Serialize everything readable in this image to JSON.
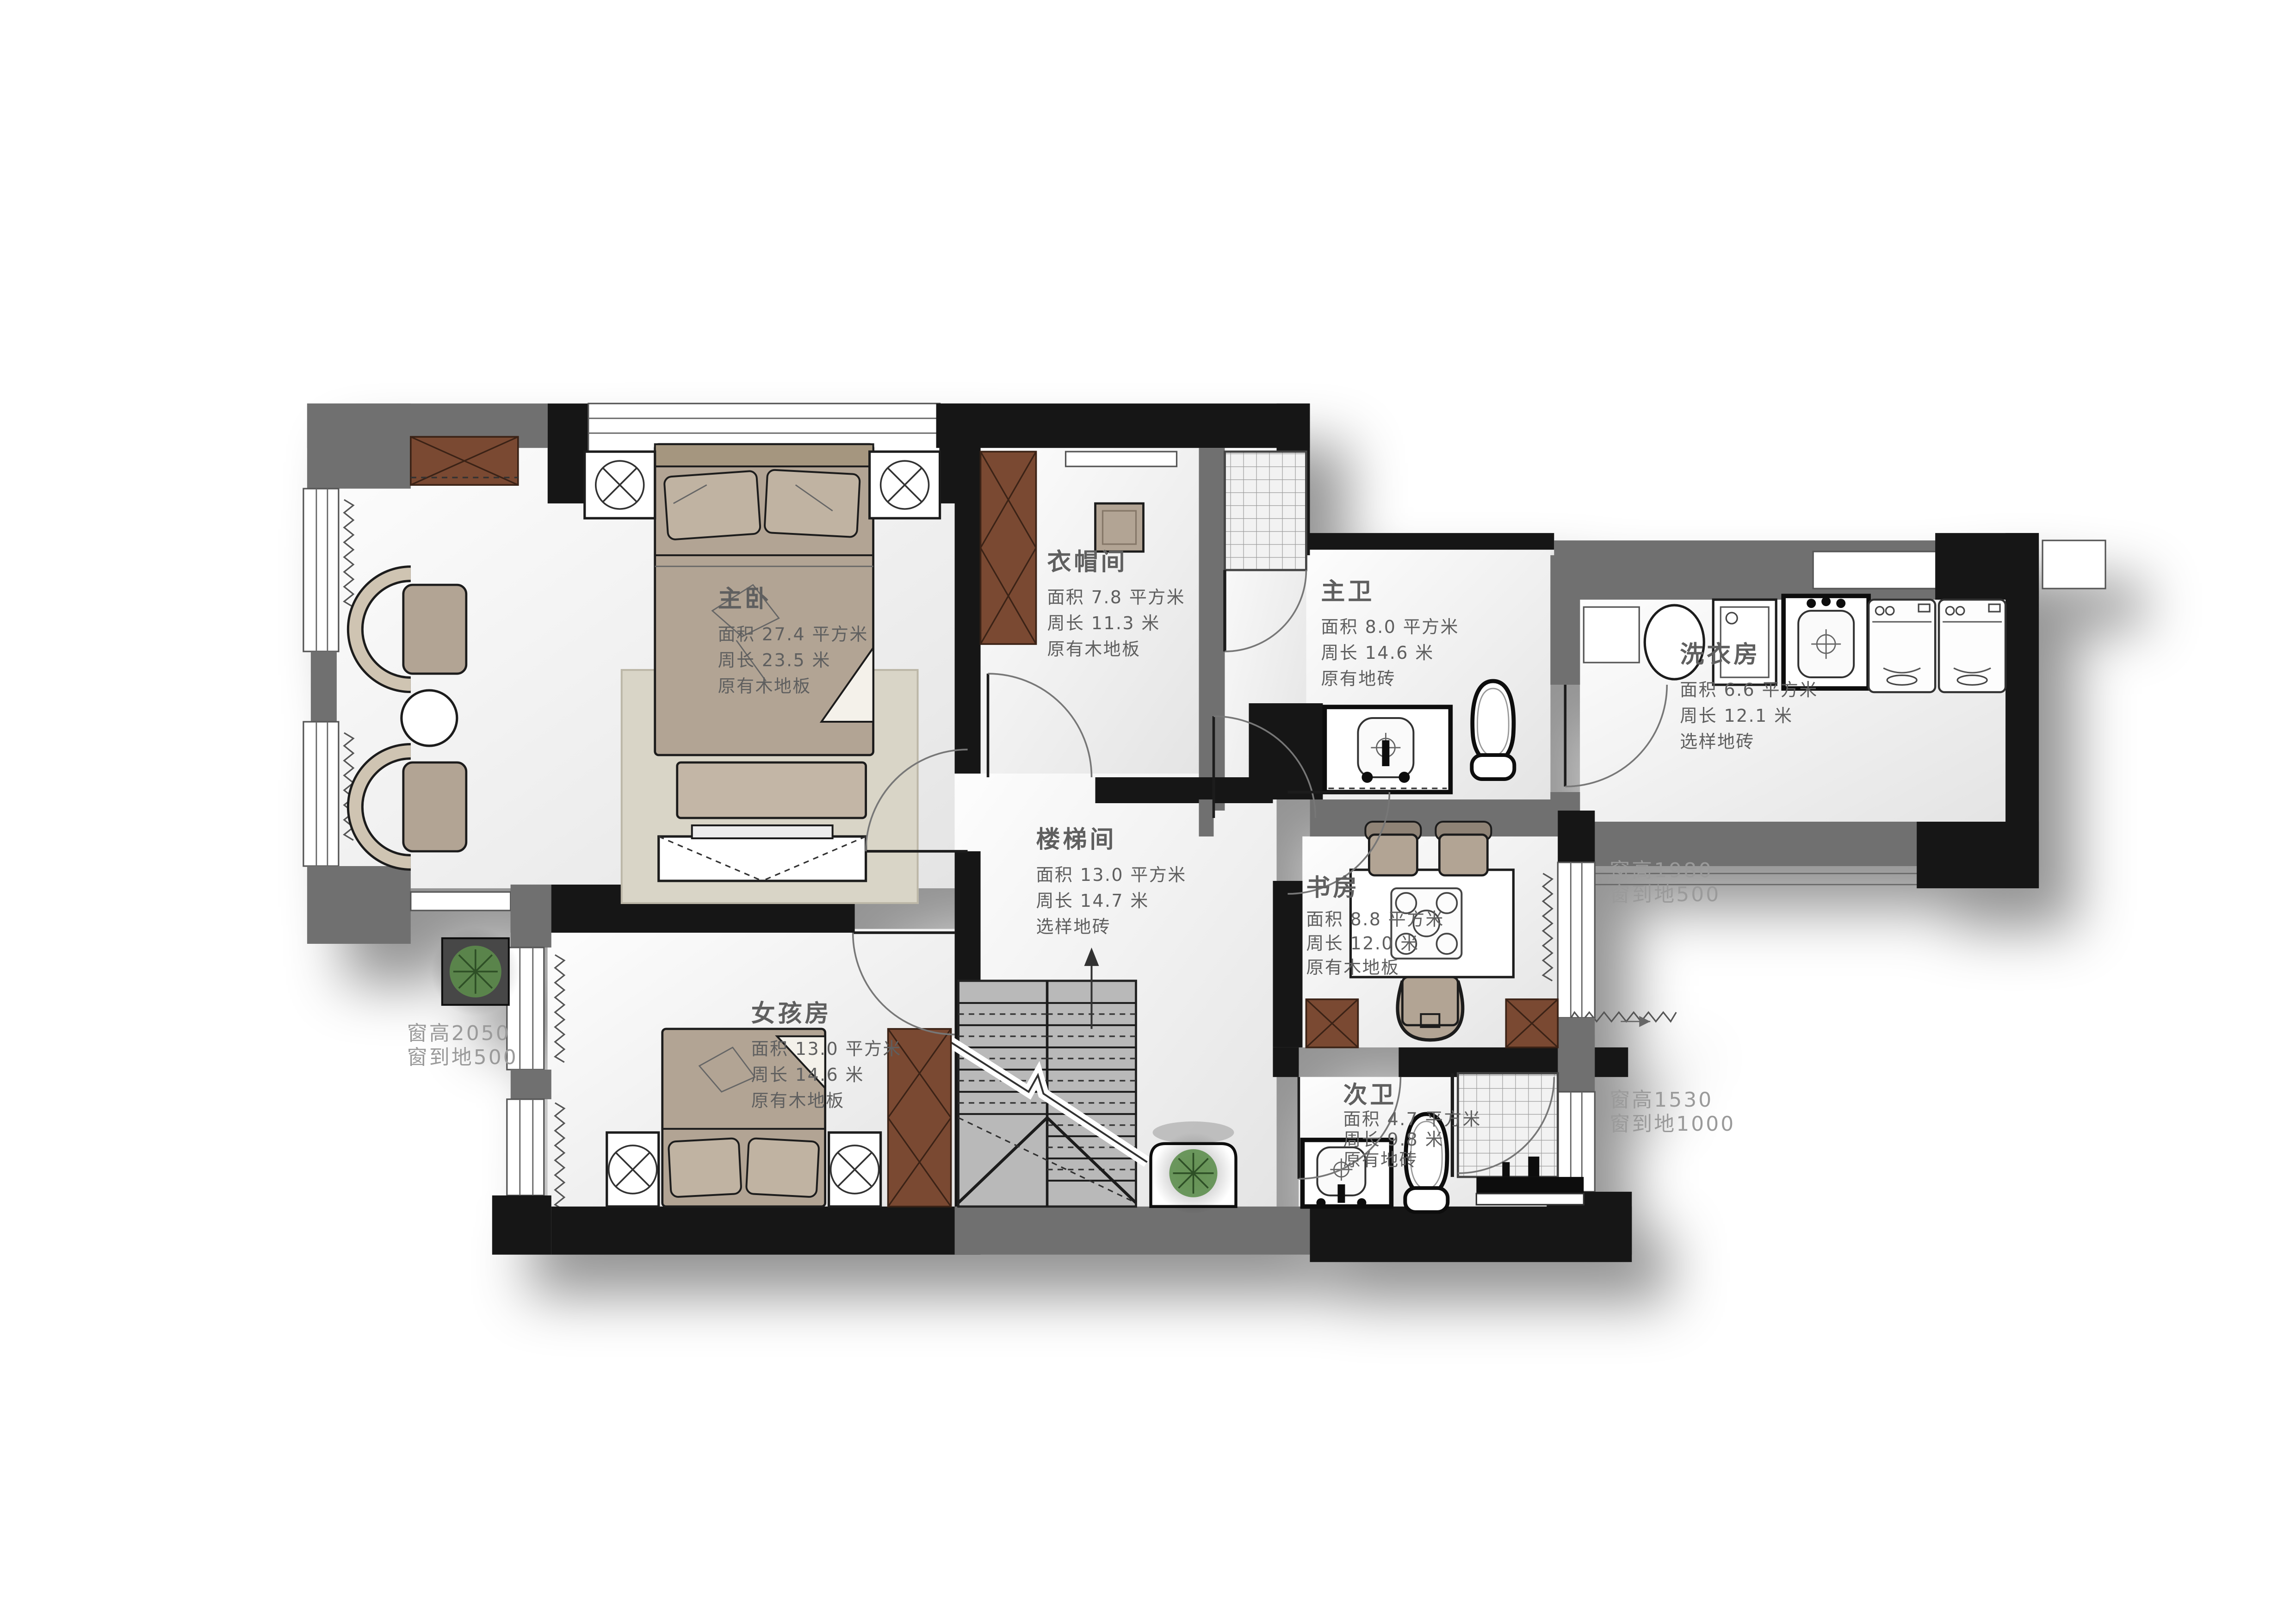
{
  "rooms": [
    {
      "id": "master-bedroom",
      "name": "主卧",
      "area": "面积 27.4 平方米",
      "perimeter": "周长 23.5 米",
      "floor": "原有木地板"
    },
    {
      "id": "walk-in-closet",
      "name": "衣帽间",
      "area": "面积 7.8 平方米",
      "perimeter": "周长 11.3 米",
      "floor": "原有木地板"
    },
    {
      "id": "master-bath",
      "name": "主卫",
      "area": "面积 8.0 平方米",
      "perimeter": "周长 14.6 米",
      "floor": "原有地砖"
    },
    {
      "id": "laundry",
      "name": "洗衣房",
      "area": "面积 6.6 平方米",
      "perimeter": "周长 12.1 米",
      "floor": "选样地砖"
    },
    {
      "id": "stairwell",
      "name": "楼梯间",
      "area": "面积 13.0 平方米",
      "perimeter": "周长 14.7 米",
      "floor": "选样地砖"
    },
    {
      "id": "study",
      "name": "书房",
      "area": "面积 8.8 平方米",
      "perimeter": "周长 12.0 米",
      "floor": "原有木地板"
    },
    {
      "id": "girls-room",
      "name": "女孩房",
      "area": "面积 13.0 平方米",
      "perimeter": "周长 14.6 米",
      "floor": "原有木地板"
    },
    {
      "id": "second-bath",
      "name": "次卫",
      "area": "面积 4.7 平方米",
      "perimeter": "周长 9.8 米",
      "floor": "原有地砖"
    }
  ],
  "window_notes": [
    {
      "id": "left-window",
      "line1": "窗高2050",
      "line2": "窗到地500"
    },
    {
      "id": "right-mid-window",
      "line1": "窗高1980",
      "line2": "窗到地500"
    },
    {
      "id": "bottom-right-window",
      "line1": "窗高1530",
      "line2": "窗到地1000"
    }
  ],
  "colors": {
    "wall-gray": "#6f6f6f",
    "wall-black": "#181818",
    "wood-brown": "#7a4a33",
    "furniture-tan": "#b2a494",
    "rug-beige": "#d9d5c7",
    "stair-gray": "#b9b9b9",
    "plant-green": "#5e8f4e",
    "label-gray": "#5f5f5f",
    "dim-gray": "#9a9a9a"
  }
}
